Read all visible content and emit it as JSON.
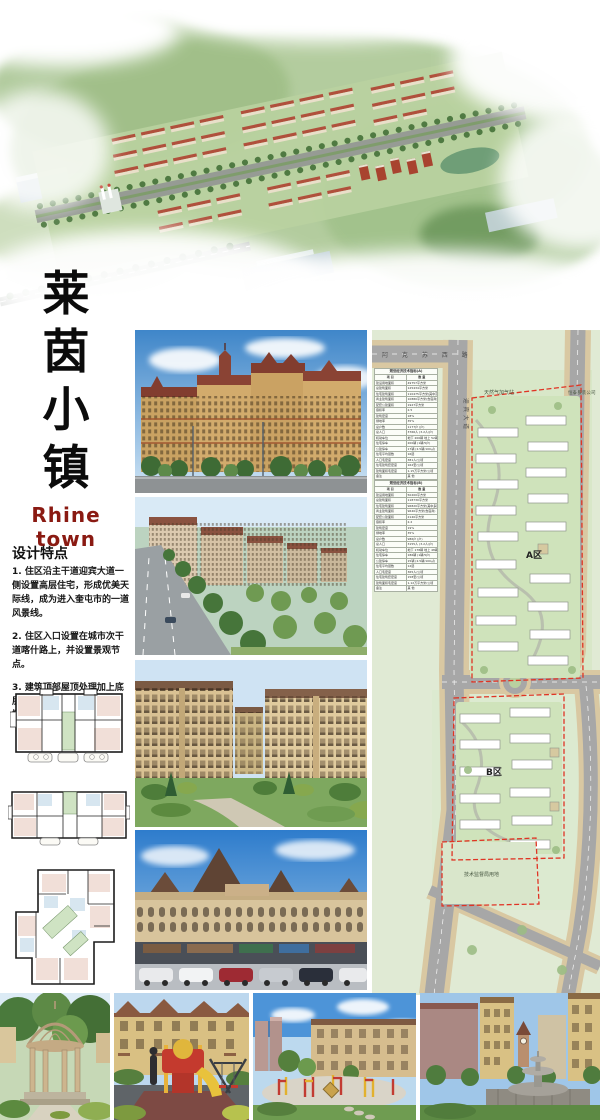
{
  "title": {
    "chars": [
      "莱",
      "茵",
      "小",
      "镇"
    ],
    "english": "Rhine  town"
  },
  "design_features": {
    "heading": "设计特点",
    "items": [
      "1. 住区沿主干道迎宾大道一侧设置高层住宅，形成优美天际线，成为进入奎屯市的一道风景线。",
      "2. 住区入口设置在城市次干道喀什路上，并设置景观节点。",
      "3. 建筑顶部屋顶处理加上底层造景营造莱茵小镇欧式风情。"
    ]
  },
  "siteplan": {
    "labels": {
      "road_top": "阿 克 苏 西 路",
      "road_main": "迎宾大道",
      "gas_station": "天然气加气站",
      "company": "恒泰服装公司",
      "zone_a": "A区",
      "zone_b": "B区",
      "tech_bureau": "技术监督局用地"
    },
    "tableA": {
      "title": "规划经济技术指标(A)",
      "rows": [
        [
          "项 目",
          "数 量"
        ],
        [
          "建设用地面积",
          "49757平方米"
        ],
        [
          "总建筑面积",
          "125434平方米"
        ],
        [
          "住宅建筑面积",
          "110475平方米(其中高层)"
        ],
        [
          "商业建筑面积",
          "10880平方米(含底商)"
        ],
        [
          "配套公建面积",
          "1927平方米"
        ],
        [
          "容积率",
          "2.5"
        ],
        [
          "建筑密度",
          "18%"
        ],
        [
          "绿地率",
          "35%"
        ],
        [
          "总户数",
          "1177户 (户)"
        ],
        [
          "总人口",
          "3766人 (3.2人/户)"
        ],
        [
          "机动车位",
          "地下 200辆  地上 52辆"
        ],
        [
          "住宅停车",
          "200辆 (1辆/5户)"
        ],
        [
          "公建停车",
          "17辆 (2.5辆/100㎡)"
        ],
        [
          "住宅平均层数",
          "16层"
        ],
        [
          "人口毛密度",
          "381人/公顷"
        ],
        [
          "住宅建筑套密度",
          "162套/公顷"
        ],
        [
          "建筑面积毛密度",
          "1.15万平方米/公顷"
        ],
        [
          "备注",
          "其 他"
        ]
      ]
    },
    "tableB": {
      "title": "规划经济技术指标(B)",
      "rows": [
        [
          "项 目",
          "数 量"
        ],
        [
          "建设用地面积",
          "50200平方米"
        ],
        [
          "总建筑面积",
          "118730平方米"
        ],
        [
          "住宅建筑面积",
          "96820平方米(其中多层)"
        ],
        [
          "商业建筑面积",
          "9640平方米(含底商)"
        ],
        [
          "配套公建面积",
          "2140平方米"
        ],
        [
          "容积率",
          "2.2"
        ],
        [
          "建筑密度",
          "19%"
        ],
        [
          "绿地率",
          "35%"
        ],
        [
          "总户数",
          "986户 (户)"
        ],
        [
          "总人口",
          "3155人 (3.2人/户)"
        ],
        [
          "机动车位",
          "地下 178辆  地上 48辆"
        ],
        [
          "住宅停车",
          "186辆 (1辆/5户)"
        ],
        [
          "公建停车",
          "15辆 (2.5辆/100㎡)"
        ],
        [
          "住宅平均层数",
          "12层"
        ],
        [
          "人口毛密度",
          "365人/公顷"
        ],
        [
          "住宅建筑套密度",
          "158套/公顷"
        ],
        [
          "建筑面积毛密度",
          "1.12万平方米/公顷"
        ],
        [
          "备注",
          "其 他"
        ]
      ]
    }
  },
  "photos": {
    "middle": [
      "high-rise residential along avenue",
      "residential buildings street view",
      "mid-rise homes with landscaping",
      "european style commercial street"
    ],
    "bottom": [
      "garden gazebo",
      "children playground",
      "fitness plaza",
      "fountain plaza"
    ]
  },
  "colors": {
    "title_red": "#8a1a12",
    "boundary_red": "#e03424",
    "plan_background": "#e0ead4",
    "roof_red": "#b0503c"
  }
}
